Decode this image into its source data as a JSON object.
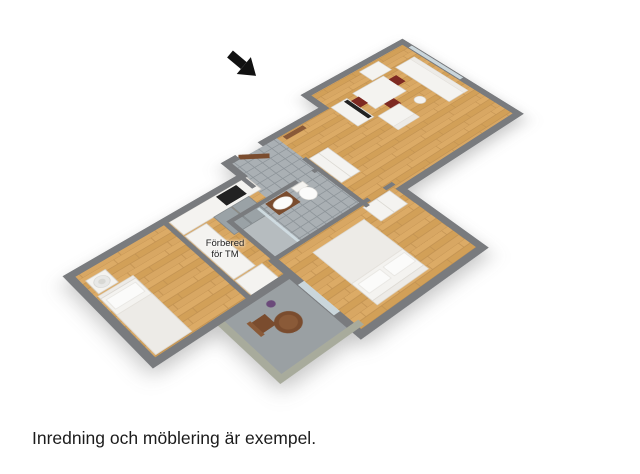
{
  "scene": {
    "type": "3d-floor-plan",
    "caption": "Inredning och möblering är exempel.",
    "annotation": {
      "line1": "Förbered",
      "line2": "för TM"
    }
  },
  "icons": {
    "entrance_arrow": "arrow-pointing-to-entrance-door"
  },
  "colors": {
    "wall": "#797b7e",
    "wall_exterior": "#a8ab9c",
    "floor_wood": "#d8a65f",
    "floor_wood_light": "#dfb06c",
    "floor_tile": "#aab0b4",
    "tile_grout": "#8f969b",
    "balcony_floor": "#9aa0a3",
    "furniture_white": "#f4f3f0",
    "accent_brown": "#7a4c2e",
    "chair_red": "#7e2a22",
    "tv_black": "#222222",
    "glass": "#d3e0e5",
    "arrow_black": "#111111",
    "text": "#1c1c1c"
  }
}
